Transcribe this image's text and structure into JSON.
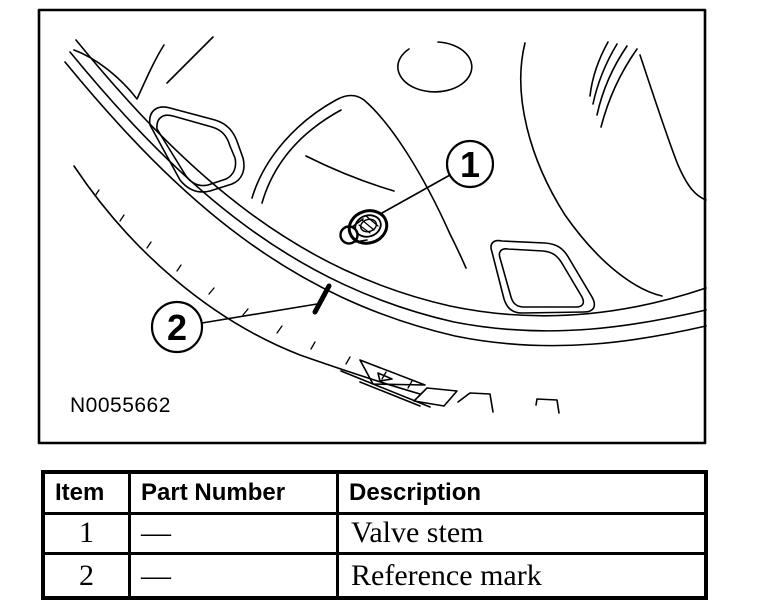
{
  "figure": {
    "caption": "N0055662",
    "callouts": [
      {
        "number": "1"
      },
      {
        "number": "2"
      }
    ],
    "colors": {
      "ink": "#000000",
      "paper": "#ffffff"
    }
  },
  "table": {
    "headers": [
      "Item",
      "Part Number",
      "Description"
    ],
    "rows": [
      {
        "item": "1",
        "part_number": "—",
        "description": "Valve stem"
      },
      {
        "item": "2",
        "part_number": "—",
        "description": "Reference mark"
      }
    ]
  }
}
